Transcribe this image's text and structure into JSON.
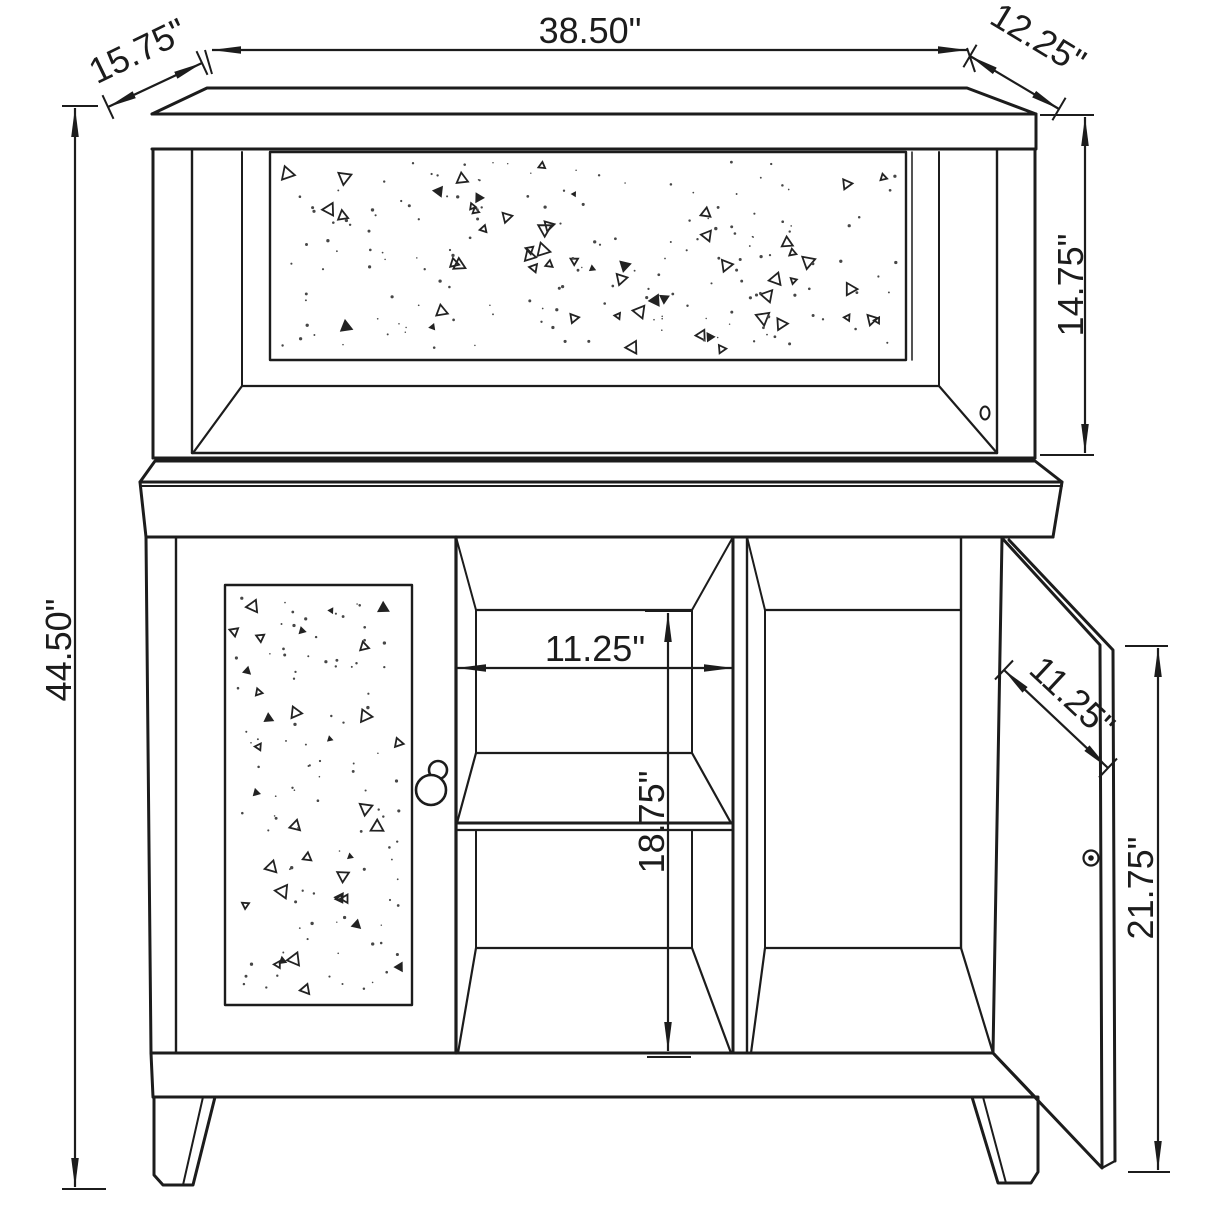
{
  "colors": {
    "ink": "#1c1c1c",
    "paper": "#ffffff"
  },
  "drawing": {
    "kind": "furniture-dimension-diagram",
    "subject": "bar cabinet with mirrored hutch, center shelves and open right door",
    "units": "inches",
    "dims": {
      "top_width": "38.50\"",
      "left_depth": "15.75\"",
      "right_depth": "12.25\"",
      "hutch_height": "14.75\"",
      "overall_height": "44.50\"",
      "center_opening_width": "11.25\"",
      "interior_height": "18.75\"",
      "right_door_depth": "11.25\"",
      "right_door_height": "21.75\""
    }
  }
}
